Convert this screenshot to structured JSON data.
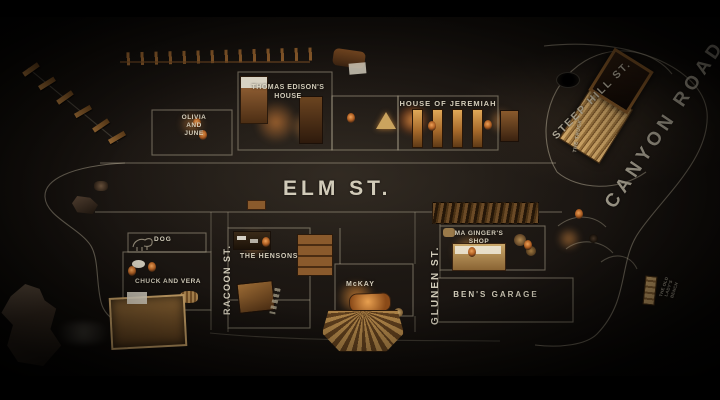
{
  "scene": {
    "description_labels_visible": true
  },
  "colors": {
    "letterbox": "#000000",
    "floor_center": "#241e18",
    "floor_edge": "#000000",
    "chalk_line": "#bdb49c",
    "chalk_text": "#e2dbc8",
    "wood_light": "#d2a868",
    "wood_dark": "#5f3a16",
    "lamp_glow": "#e8914a"
  },
  "streets": {
    "elm": {
      "label": "ELM ST."
    },
    "canyon": {
      "label": "CANYON ROAD"
    },
    "steep_hill": {
      "label": "STEEP HILL ST."
    },
    "racoon": {
      "label": "RACOON ST."
    },
    "glunen": {
      "label": "GLUNEN ST."
    }
  },
  "places": {
    "thomas_edison": {
      "line1": "THOMAS EDISON'S",
      "line2": "HOUSE"
    },
    "olivia_june": {
      "line1": "OLIVIA",
      "line2": "AND",
      "line3": "JUNE"
    },
    "jeremiah": {
      "label": "HOUSE OF JEREMIAH"
    },
    "dog": {
      "label": "DOG"
    },
    "hensons": {
      "label": "THE HENSONS"
    },
    "chuck_vera": {
      "label": "CHUCK AND VERA"
    },
    "mckay": {
      "label": "McKAY"
    },
    "ma_ginger": {
      "line1": "MA GINGER'S",
      "line2": "SHOP"
    },
    "bens_garage": {
      "label": "BEN'S GARAGE"
    },
    "truck": {
      "label": "THE TRUCK"
    },
    "old_ladys_bench": {
      "label": "THE OLD LADY'S BENCH"
    }
  }
}
